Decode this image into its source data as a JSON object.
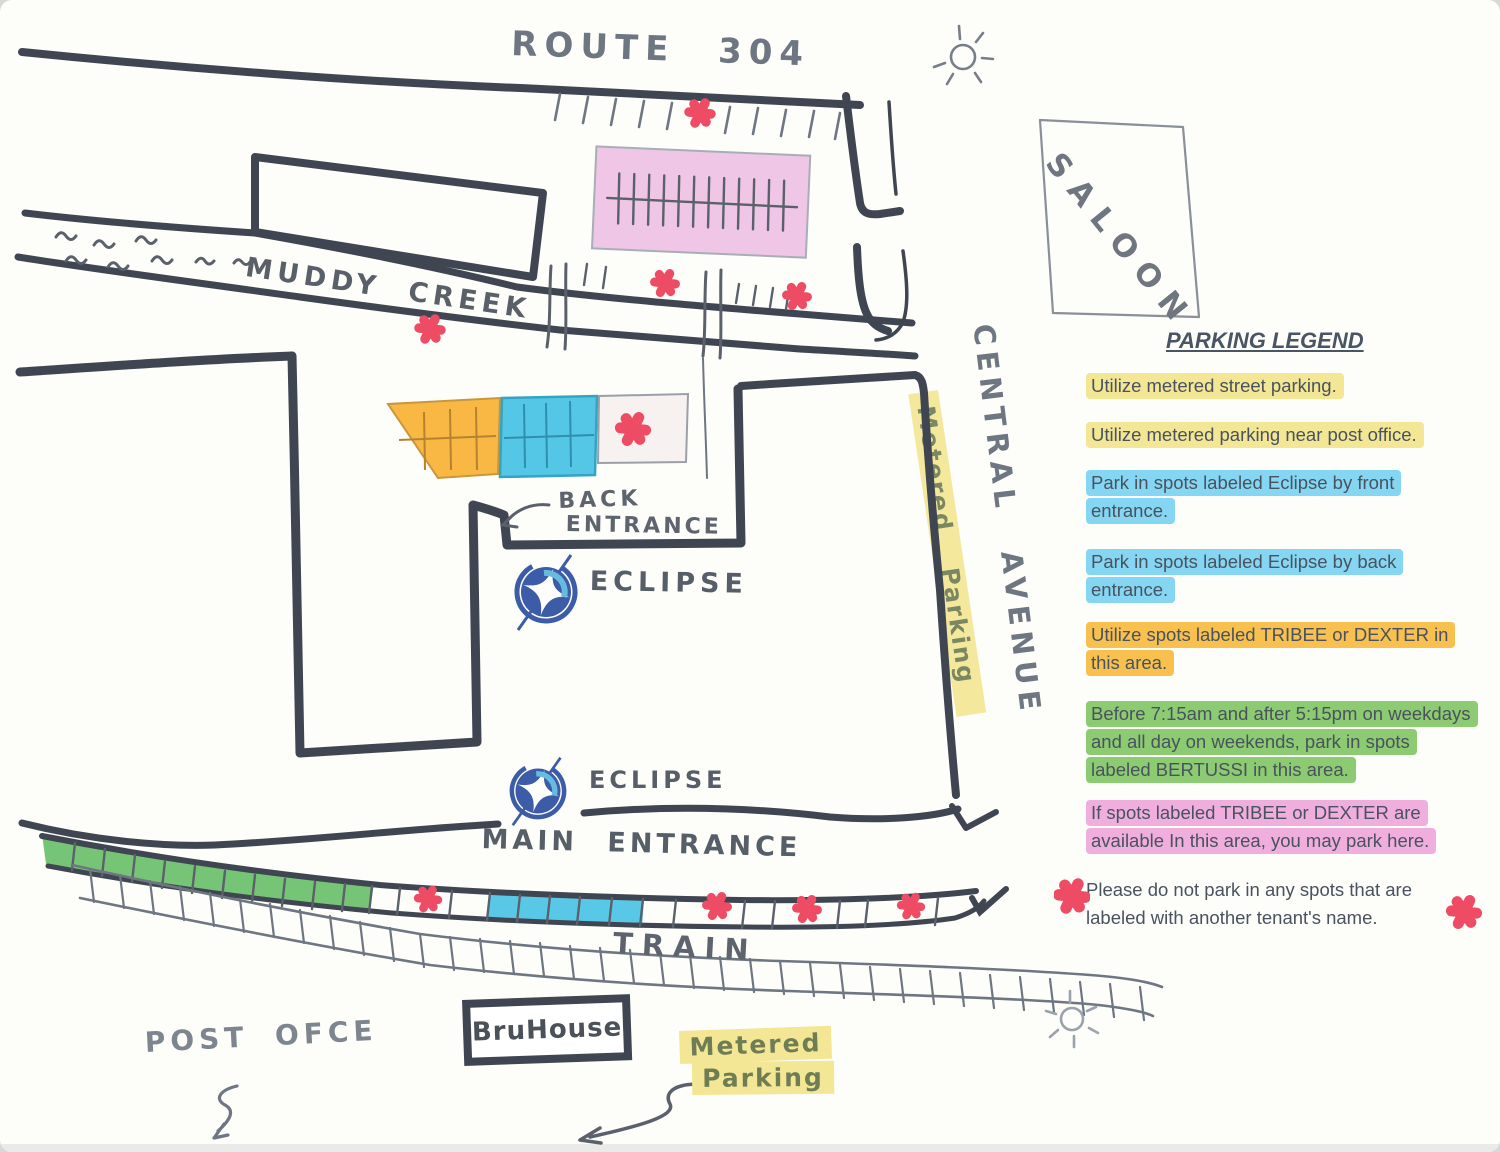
{
  "colors": {
    "paper": "#fdfdfa",
    "road": "#3f4652",
    "pencil": "#6e7681",
    "pencil_dark": "#5a616b",
    "red_marker": "#ee4b64",
    "lot_pink": "#f0c6e6",
    "lot_orange": "#f9b844",
    "lot_cyan": "#54c6e6",
    "lot_white": "#f7f2ef",
    "strip_green": "#76c577",
    "strip_blue": "#59c8e6",
    "hl_yellow": "#f3e795",
    "hl_blue": "#84d6f2",
    "hl_orange": "#f8c14f",
    "hl_green": "#8ccb71",
    "hl_pink": "#f0aede",
    "eclipse_blue": "#3c5ca8",
    "eclipse_light": "#66bbdf",
    "hand_green": "#6f7d55",
    "legend_text": "#49525e"
  },
  "map": {
    "labels": {
      "route": "ROUTE 304",
      "creek": "MUDDY CREEK",
      "saloon": "SALOON",
      "central_avenue": "CENTRAL AVENUE",
      "metered_parking_street": "Metered Parking",
      "back_entrance_l1": "BACK",
      "back_entrance_l2": "ENTRANCE",
      "eclipse": "ECLIPSE",
      "main_entrance": "MAIN ENTRANCE",
      "train": "TRAIN",
      "bruhouse": "BruHouse",
      "metered_l1": "Metered",
      "metered_l2": "Parking",
      "post_office": "POST OFCE"
    },
    "no_parking_markers": [
      {
        "x": 700,
        "y": 113,
        "s": 1.0
      },
      {
        "x": 665,
        "y": 283,
        "s": 0.95
      },
      {
        "x": 797,
        "y": 296,
        "s": 0.95
      },
      {
        "x": 430,
        "y": 329,
        "s": 1.0
      },
      {
        "x": 633,
        "y": 429,
        "s": 1.15
      },
      {
        "x": 428,
        "y": 899,
        "s": 0.9
      },
      {
        "x": 717,
        "y": 906,
        "s": 0.95
      },
      {
        "x": 807,
        "y": 909,
        "s": 0.95
      },
      {
        "x": 911,
        "y": 906,
        "s": 0.9
      }
    ]
  },
  "legend": {
    "title": "PARKING LEGEND",
    "items": [
      {
        "text": "Utilize metered street parking.",
        "highlight": "yellow"
      },
      {
        "text": "Utilize metered parking near post office.",
        "highlight": "yellow"
      },
      {
        "text": "Park in spots labeled Eclipse by front entrance.",
        "highlight": "blue"
      },
      {
        "text": "Park in spots labeled Eclipse by back entrance.",
        "highlight": "blue"
      },
      {
        "text": "Utilize spots labeled TRIBEE or DEXTER in this area.",
        "highlight": "orange"
      },
      {
        "text": "Before 7:15am and after 5:15pm on weekdays and all day on weekends, park in spots labeled BERTUSSI in this area.",
        "highlight": "green"
      },
      {
        "text": "If spots labeled TRIBEE or DEXTER are available In this area, you may park here.",
        "highlight": "pink"
      },
      {
        "text": "Please do not park in any spots that are labeled with another tenant's name.",
        "highlight": "none"
      }
    ]
  }
}
